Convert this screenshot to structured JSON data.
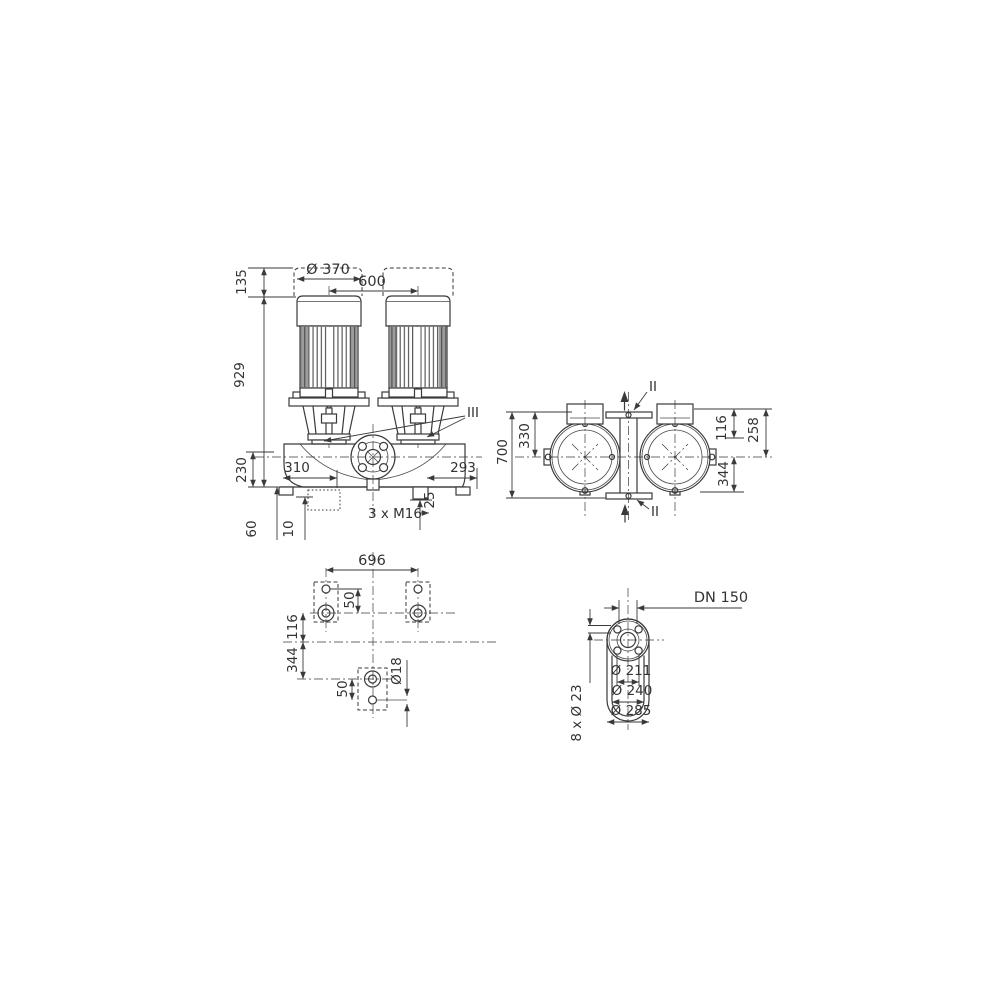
{
  "front": {
    "d135": "135",
    "d929": "929",
    "d230": "230",
    "d370": "Ø 370",
    "d600": "600",
    "d310": "310",
    "d293": "293",
    "d25": "25",
    "dm16": "3 x M16",
    "d60": "60",
    "d10": "10",
    "liii": "III"
  },
  "top": {
    "d700": "700",
    "d330": "330",
    "d116": "116",
    "d258": "258",
    "d344": "344",
    "lii_top": "II",
    "lii_bottom": "II"
  },
  "plan": {
    "d696": "696",
    "d50_top": "50",
    "d116": "116",
    "d344": "344",
    "d50_bottom": "50",
    "d18": "Ø18"
  },
  "flange": {
    "dn": "DN 150",
    "bolt_note": "8 x Ø 23",
    "d211": "Ø 211",
    "d240": "Ø 240",
    "d285": "Ø 285"
  },
  "colors": {
    "line": "#3a3a3a",
    "shade": "#9c9c9c",
    "background": "#ffffff"
  }
}
